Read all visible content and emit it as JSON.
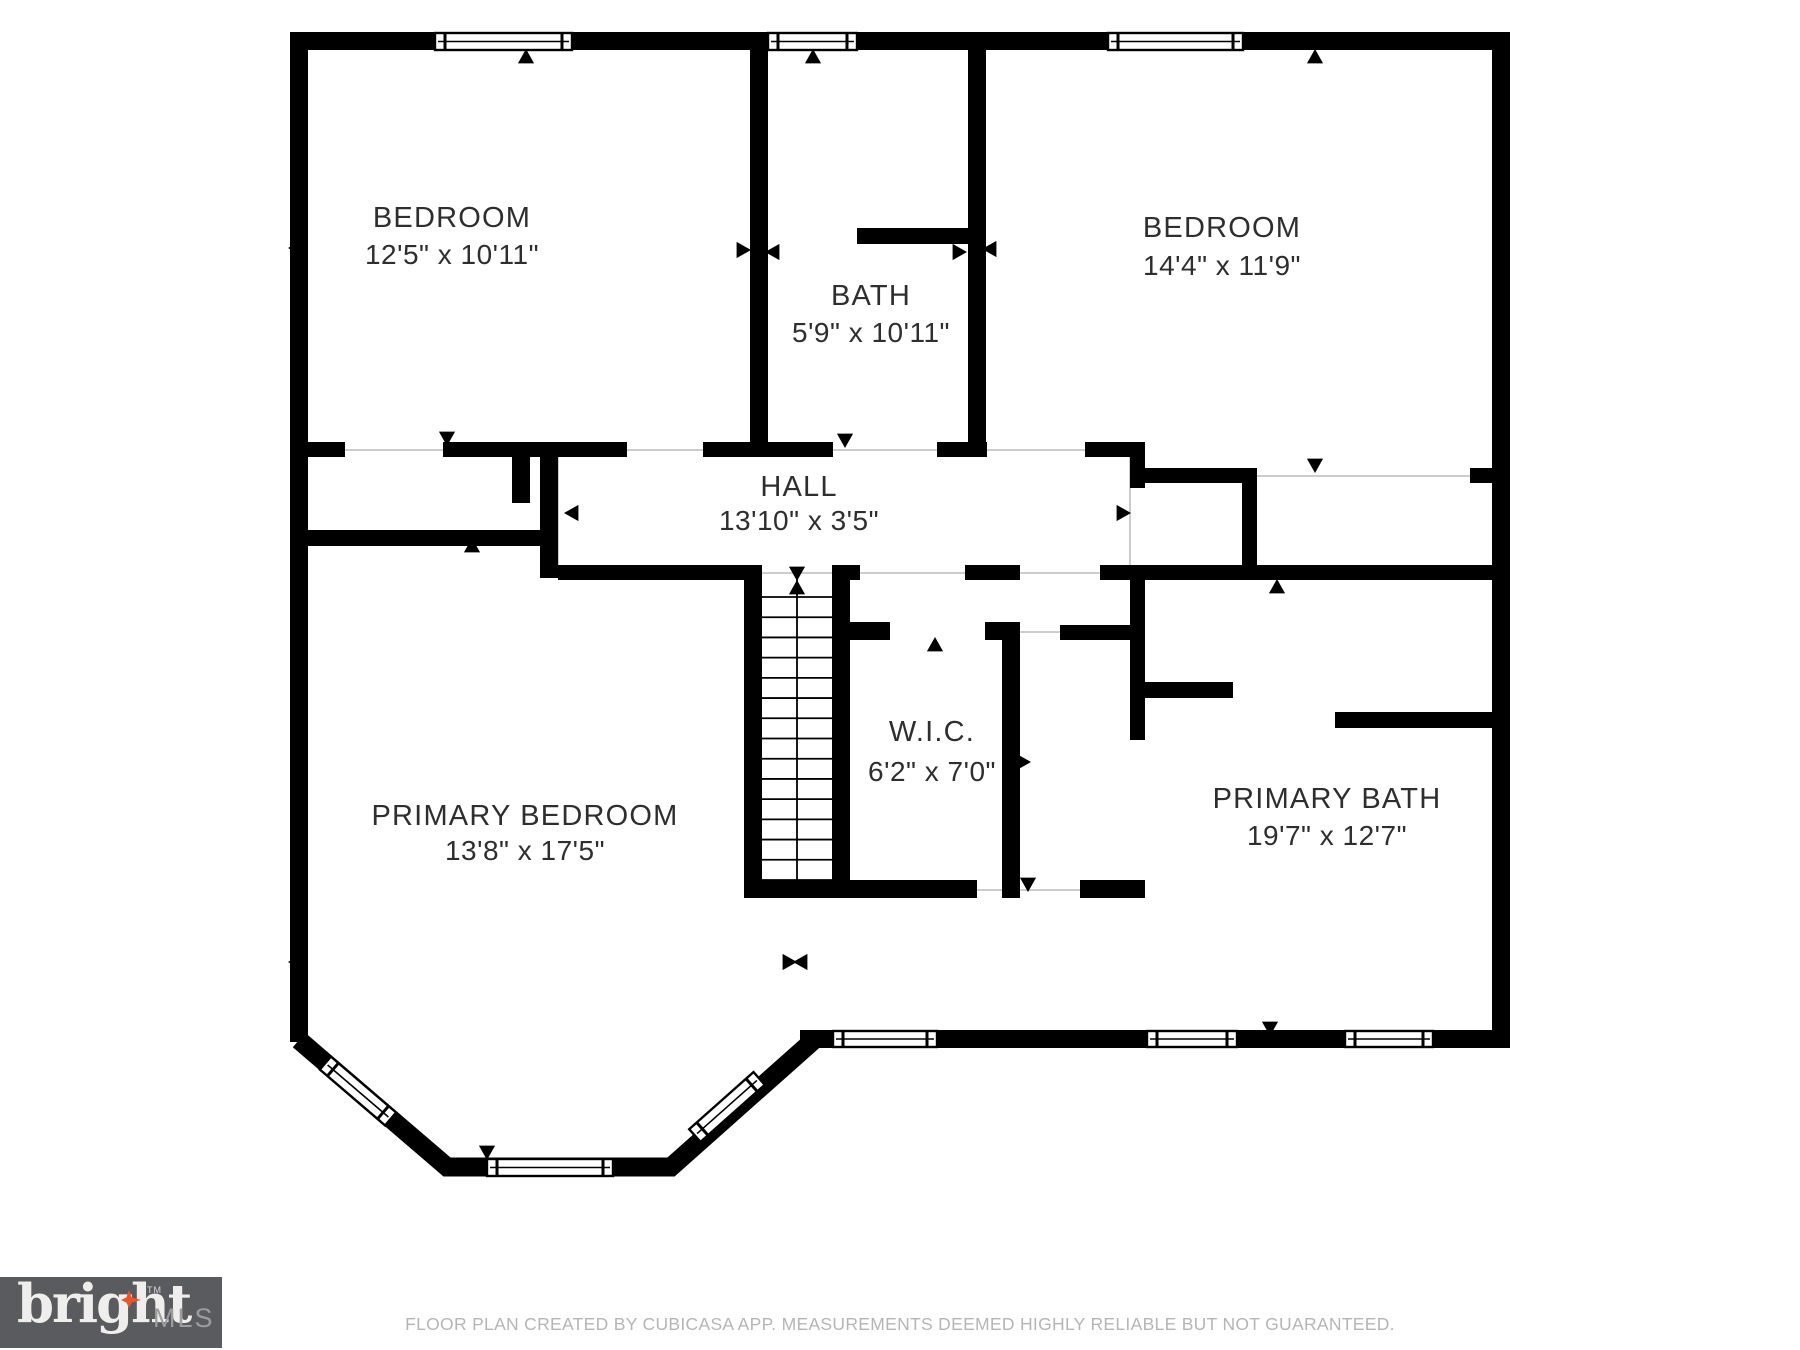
{
  "page": {
    "background": "#ffffff"
  },
  "floor_plan": {
    "wall_color": "#000000",
    "label_color": "#2e2e2e",
    "separator_color": "#cccccc",
    "rooms": [
      {
        "id": "bedroom-1",
        "name": "BEDROOM",
        "dims": "12'5\" x 10'11\"",
        "cx": 452,
        "name_y": 227,
        "dims_y": 264
      },
      {
        "id": "bath",
        "name": "BATH",
        "dims": "5'9\" x 10'11\"",
        "cx": 871,
        "name_y": 305,
        "dims_y": 342
      },
      {
        "id": "bedroom-2",
        "name": "BEDROOM",
        "dims": "14'4\" x 11'9\"",
        "cx": 1222,
        "name_y": 237,
        "dims_y": 275
      },
      {
        "id": "hall",
        "name": "HALL",
        "dims": "13'10\" x 3'5\"",
        "cx": 799,
        "name_y": 496,
        "dims_y": 530
      },
      {
        "id": "walk-in-closet",
        "name": "W.I.C.",
        "dims": "6'2\" x 7'0\"",
        "cx": 932,
        "name_y": 741,
        "dims_y": 781
      },
      {
        "id": "primary-bedroom",
        "name": "PRIMARY BEDROOM",
        "dims": "13'8\" x 17'5\"",
        "cx": 525,
        "name_y": 825,
        "dims_y": 860
      },
      {
        "id": "primary-bath",
        "name": "PRIMARY BATH",
        "dims": "19'7\" x 12'7\"",
        "cx": 1327,
        "name_y": 808,
        "dims_y": 845
      }
    ],
    "walls": [
      [
        290,
        32,
        1220,
        18
      ],
      [
        290,
        32,
        18,
        1010
      ],
      [
        1492,
        32,
        18,
        1016
      ],
      [
        800,
        1030,
        710,
        18
      ],
      [
        750,
        50,
        18,
        407
      ],
      [
        968,
        50,
        18,
        407
      ],
      [
        857,
        228,
        111,
        16
      ],
      [
        307,
        442,
        38,
        15
      ],
      [
        443,
        442,
        97,
        15
      ],
      [
        512,
        457,
        18,
        46
      ],
      [
        540,
        442,
        87,
        15
      ],
      [
        703,
        442,
        130,
        15
      ],
      [
        937,
        442,
        50,
        15
      ],
      [
        1085,
        442,
        60,
        15
      ],
      [
        1130,
        442,
        15,
        46
      ],
      [
        1143,
        468,
        114,
        15
      ],
      [
        1242,
        483,
        15,
        84
      ],
      [
        1470,
        468,
        22,
        15
      ],
      [
        540,
        442,
        18,
        136
      ],
      [
        307,
        530,
        236,
        16
      ],
      [
        558,
        565,
        190,
        15
      ],
      [
        832,
        565,
        28,
        15
      ],
      [
        965,
        565,
        55,
        15
      ],
      [
        1100,
        565,
        392,
        15
      ],
      [
        744,
        565,
        18,
        333
      ],
      [
        832,
        580,
        18,
        318
      ],
      [
        850,
        622,
        40,
        18
      ],
      [
        985,
        622,
        35,
        18
      ],
      [
        1002,
        622,
        18,
        276
      ],
      [
        1060,
        625,
        70,
        15
      ],
      [
        1130,
        565,
        15,
        175
      ],
      [
        744,
        880,
        233,
        18
      ],
      [
        1080,
        880,
        65,
        18
      ],
      [
        1145,
        682,
        88,
        16
      ],
      [
        1335,
        712,
        157,
        16
      ]
    ],
    "bay_wall_path": "M299,1040 L447,1167 L671,1167 L815,1039",
    "windows": [
      [
        435,
        33,
        137,
        17
      ],
      [
        768,
        33,
        89,
        17
      ],
      [
        1108,
        33,
        135,
        17
      ],
      [
        833,
        1031,
        104,
        16
      ],
      [
        1147,
        1031,
        90,
        16
      ],
      [
        1345,
        1031,
        88,
        16
      ],
      [
        487,
        1159,
        126,
        17
      ]
    ],
    "bay_windows": [
      {
        "cx": 358,
        "cy": 1091,
        "w": 86,
        "h": 17,
        "angle": 40.6
      },
      {
        "cx": 727,
        "cy": 1107,
        "w": 86,
        "h": 17,
        "angle": -41.6
      }
    ],
    "stairs": {
      "x1": 762,
      "x2": 832,
      "y1": 597,
      "y2": 880,
      "treads": 15
    },
    "door_markers": [
      [
        526,
        58,
        "u"
      ],
      [
        813,
        58,
        "u"
      ],
      [
        1315,
        58,
        "u"
      ],
      [
        447,
        437,
        "d"
      ],
      [
        845,
        439,
        "d"
      ],
      [
        742,
        250,
        "r"
      ],
      [
        774,
        252,
        "l"
      ],
      [
        958,
        252,
        "r"
      ],
      [
        991,
        249,
        "l"
      ],
      [
        297,
        248,
        "l"
      ],
      [
        1498,
        246,
        "r"
      ],
      [
        573,
        513,
        "l"
      ],
      [
        1122,
        513,
        "r"
      ],
      [
        1315,
        464,
        "d"
      ],
      [
        1277,
        588,
        "u"
      ],
      [
        797,
        572,
        "d"
      ],
      [
        797,
        589,
        "u"
      ],
      [
        935,
        646,
        "u"
      ],
      [
        843,
        762,
        "l"
      ],
      [
        1022,
        762,
        "r"
      ],
      [
        1028,
        883,
        "d"
      ],
      [
        788,
        962,
        "r"
      ],
      [
        802,
        962,
        "l"
      ],
      [
        297,
        962,
        "l"
      ],
      [
        1498,
        960,
        "r"
      ],
      [
        487,
        1151,
        "d"
      ],
      [
        1270,
        1027,
        "d"
      ],
      [
        472,
        547,
        "u"
      ]
    ],
    "separators": [
      [
        345,
        450,
        443,
        450
      ],
      [
        627,
        450,
        703,
        450
      ],
      [
        833,
        450,
        937,
        450
      ],
      [
        987,
        450,
        1085,
        450
      ],
      [
        1257,
        476,
        1470,
        476
      ],
      [
        558,
        457,
        558,
        565
      ],
      [
        1130,
        457,
        1130,
        565
      ],
      [
        762,
        573,
        832,
        573
      ],
      [
        860,
        573,
        965,
        573
      ],
      [
        1020,
        573,
        1100,
        573
      ],
      [
        977,
        890,
        1080,
        890
      ],
      [
        1020,
        632,
        1060,
        632
      ]
    ]
  },
  "footer": {
    "text": "FLOOR PLAN CREATED BY CUBICASA APP. MEASUREMENTS DEEMED HIGHLY RELIABLE BUT NOT GUARANTEED.",
    "color": "#b5b5b5"
  },
  "logo": {
    "brand": "bright",
    "tm": "TM",
    "suffix": "MLS",
    "background": "#5a5b5e",
    "brand_color": "#efeeec",
    "star_color": "#e8542e",
    "suffix_color": "#9c9da0"
  }
}
